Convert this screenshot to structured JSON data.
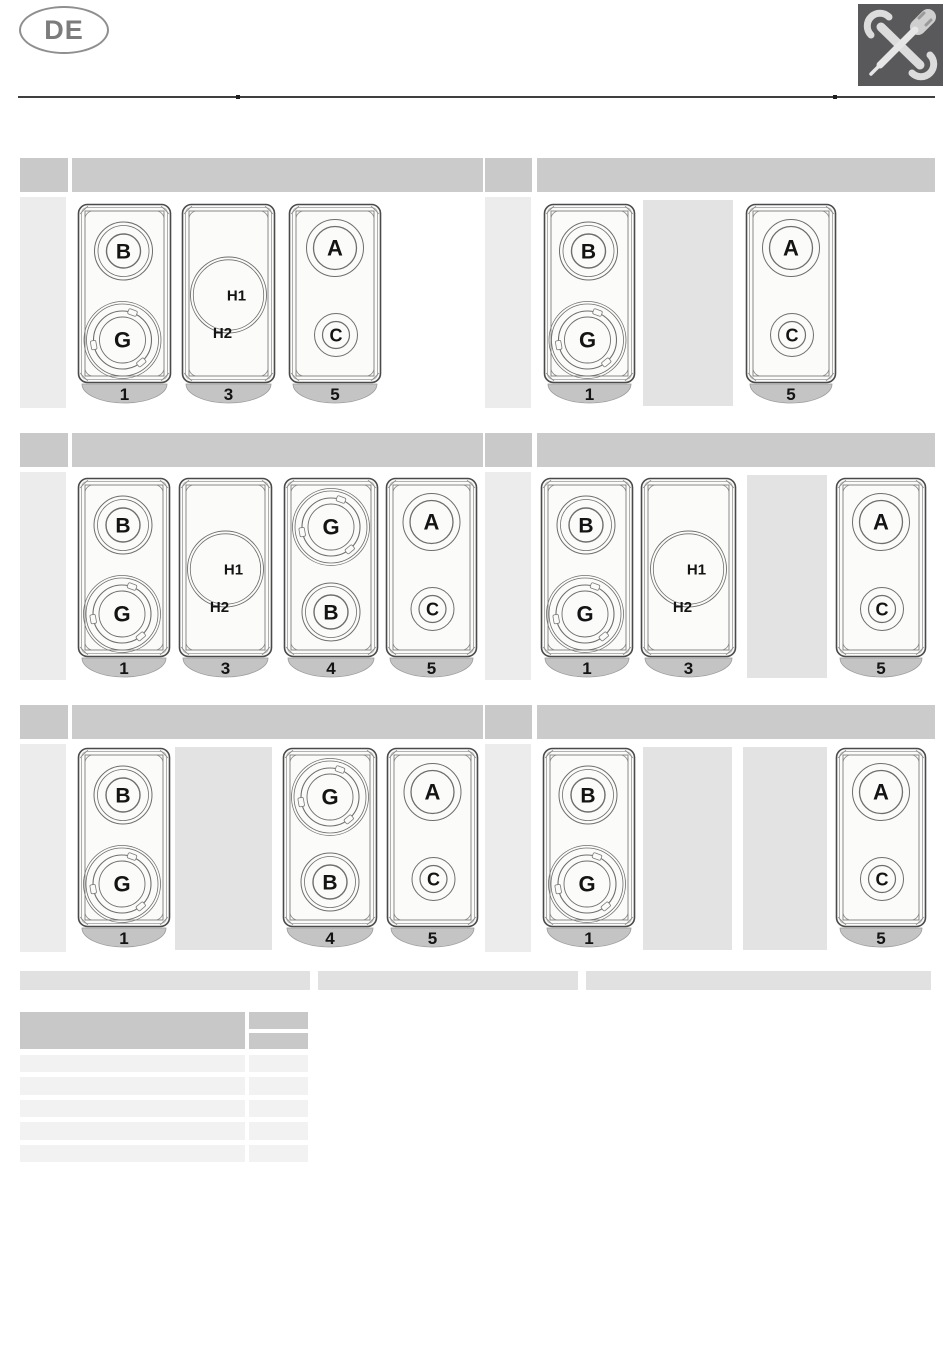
{
  "header": {
    "language_badge": "DE",
    "tool_icon": "wrench-screwdriver-icon"
  },
  "sections": [
    {
      "name": "top-left",
      "index_label": "",
      "title": "",
      "panels": [
        {
          "kind": "panel",
          "type": "BG",
          "number": "1",
          "labels": [
            "B",
            "G"
          ]
        },
        {
          "kind": "panel",
          "type": "H",
          "number": "3",
          "labels": [
            "H1",
            "H2"
          ]
        },
        {
          "kind": "panel",
          "type": "AC",
          "number": "5",
          "labels": [
            "A",
            "C"
          ]
        }
      ]
    },
    {
      "name": "top-right",
      "index_label": "",
      "title": "",
      "panels": [
        {
          "kind": "panel",
          "type": "BG",
          "number": "1",
          "labels": [
            "B",
            "G"
          ]
        },
        {
          "kind": "placeholder"
        },
        {
          "kind": "panel",
          "type": "AC",
          "number": "5",
          "labels": [
            "A",
            "C"
          ]
        }
      ]
    },
    {
      "name": "middle-left",
      "index_label": "",
      "title": "",
      "panels": [
        {
          "kind": "panel",
          "type": "BG",
          "number": "1",
          "labels": [
            "B",
            "G"
          ]
        },
        {
          "kind": "panel",
          "type": "H",
          "number": "3",
          "labels": [
            "H1",
            "H2"
          ]
        },
        {
          "kind": "panel",
          "type": "GB",
          "number": "4",
          "labels": [
            "G",
            "B"
          ]
        },
        {
          "kind": "panel",
          "type": "AC",
          "number": "5",
          "labels": [
            "A",
            "C"
          ]
        }
      ]
    },
    {
      "name": "middle-right",
      "index_label": "",
      "title": "",
      "panels": [
        {
          "kind": "panel",
          "type": "BG",
          "number": "1",
          "labels": [
            "B",
            "G"
          ]
        },
        {
          "kind": "panel",
          "type": "H",
          "number": "3",
          "labels": [
            "H1",
            "H2"
          ]
        },
        {
          "kind": "placeholder"
        },
        {
          "kind": "panel",
          "type": "AC",
          "number": "5",
          "labels": [
            "A",
            "C"
          ]
        }
      ]
    },
    {
      "name": "bottom-left",
      "index_label": "",
      "title": "",
      "panels": [
        {
          "kind": "panel",
          "type": "BG",
          "number": "1",
          "labels": [
            "B",
            "G"
          ]
        },
        {
          "kind": "placeholder"
        },
        {
          "kind": "panel",
          "type": "GB",
          "number": "4",
          "labels": [
            "G",
            "B"
          ]
        },
        {
          "kind": "panel",
          "type": "AC",
          "number": "5",
          "labels": [
            "A",
            "C"
          ]
        }
      ]
    },
    {
      "name": "bottom-right",
      "index_label": "",
      "title": "",
      "panels": [
        {
          "kind": "panel",
          "type": "BG",
          "number": "1",
          "labels": [
            "B",
            "G"
          ]
        },
        {
          "kind": "placeholder"
        },
        {
          "kind": "placeholder"
        },
        {
          "kind": "panel",
          "type": "AC",
          "number": "5",
          "labels": [
            "A",
            "C"
          ]
        }
      ]
    }
  ],
  "caption_bars": [
    "",
    "",
    ""
  ],
  "table": {
    "header_left": "",
    "header_right_rows": [
      "",
      ""
    ],
    "rows": [
      [
        "",
        ""
      ],
      [
        "",
        ""
      ],
      [
        "",
        ""
      ],
      [
        "",
        ""
      ],
      [
        "",
        ""
      ]
    ]
  },
  "colors": {
    "section_header": "#cbcbcb",
    "placeholder": "#e3e3e3",
    "table_header": "#c8c8c8",
    "table_row": "#f2f2f2",
    "panel_face": "#fbfbf9",
    "number_tab": "#c4c4c4",
    "icon_background": "#59595b"
  }
}
